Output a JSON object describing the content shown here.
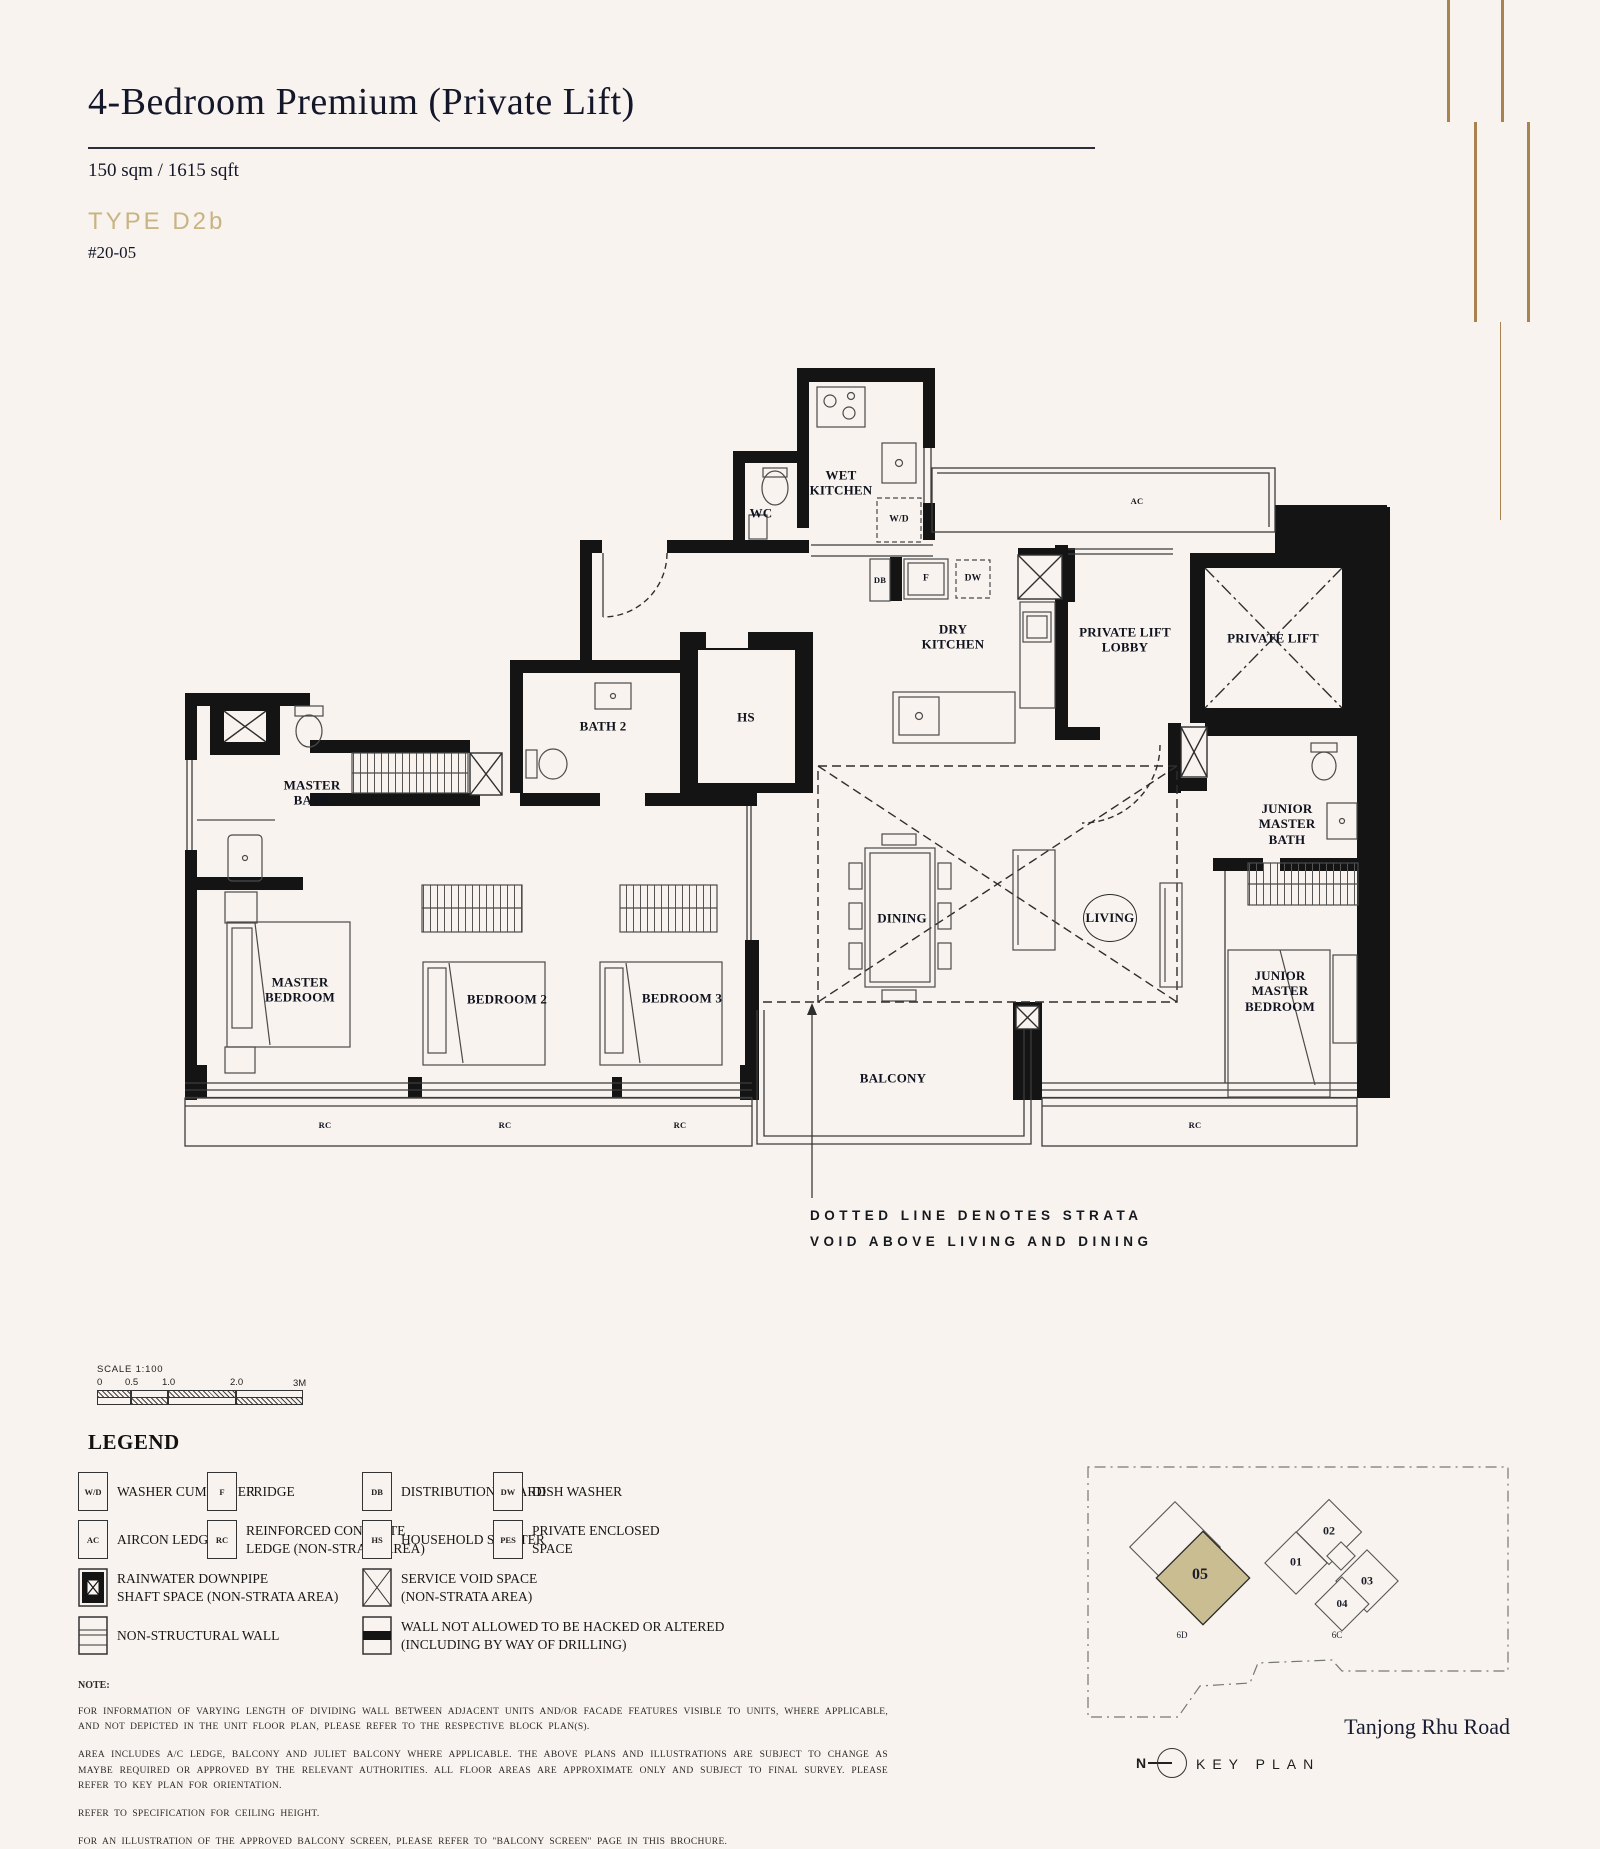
{
  "header": {
    "title": "4-Bedroom Premium (Private Lift)",
    "area": "150 sqm / 1615 sqft",
    "type_label": "TYPE D2b",
    "unit_number": "#20-05"
  },
  "colors": {
    "background": "#f8f3ee",
    "accent_gold": "#c8b483",
    "decor_line_gold": "#a9834f",
    "wall_black": "#141414",
    "highlight_unit_tan": "#cbbd92"
  },
  "plan": {
    "labels": {
      "wet_kitchen": "WET\nKITCHEN",
      "wc": "WC",
      "wd": "W/D",
      "ac": "AC",
      "db": "DB",
      "fridge": "F",
      "dw": "DW",
      "dry_kitchen": "DRY\nKITCHEN",
      "lift_lobby": "PRIVATE LIFT\nLOBBY",
      "lift": "PRIVATE LIFT",
      "hs": "HS",
      "bath2": "BATH 2",
      "master_bath": "MASTER\nBATH",
      "master_bedroom": "MASTER\nBEDROOM",
      "bedroom2": "BEDROOM 2",
      "bedroom3": "BEDROOM 3",
      "dining": "DINING",
      "living": "LIVING",
      "balcony": "BALCONY",
      "junior_master_bath": "JUNIOR\nMASTER\nBATH",
      "junior_master_bedroom": "JUNIOR\nMASTER\nBEDROOM",
      "rc": "RC"
    },
    "annotation": "DOTTED LINE DENOTES STRATA\nVOID ABOVE LIVING AND DINING"
  },
  "scale_bar": {
    "label": "SCALE  1:100",
    "ticks": [
      "0",
      "0.5",
      "1.0",
      "2.0",
      "3M"
    ]
  },
  "legend": {
    "title": "LEGEND",
    "items": [
      {
        "box": "W/D",
        "label": "WASHER CUM DRYER"
      },
      {
        "box": "F",
        "label": "FRIDGE"
      },
      {
        "box": "DB",
        "label": "DISTRIBUTION BOARD"
      },
      {
        "box": "DW",
        "label": "DISH WASHER"
      },
      {
        "box": "AC",
        "label": "AIRCON LEDGE"
      },
      {
        "box": "RC",
        "label": "REINFORCED CONCRETE\nLEDGE (NON-STRATA AREA)"
      },
      {
        "box": "HS",
        "label": "HOUSEHOLD SHELTER"
      },
      {
        "box": "PES",
        "label": "PRIVATE ENCLOSED\nSPACE"
      },
      {
        "box": "",
        "label": "RAINWATER DOWNPIPE\nSHAFT SPACE (NON-STRATA AREA)"
      },
      {
        "box": "",
        "label": "SERVICE VOID SPACE\n(NON-STRATA AREA)"
      },
      {
        "box": "",
        "label": "NON-STRUCTURAL WALL"
      },
      {
        "box": "",
        "label": "WALL NOT ALLOWED TO BE HACKED OR ALTERED\n(INCLUDING BY WAY OF DRILLING)"
      }
    ]
  },
  "notes": {
    "heading": "NOTE:",
    "paragraphs": [
      "FOR  INFORMATION OF  VARYING  LENGTH  OF  DIVIDING WALL  BETWEEN  ADJACENT  UNITS  AND/OR  FACADE  FEATURES  VISIBLE  TO UNITS, WHERE  APPLICABLE,  AND NOT DEPICTED  IN THE UNIT FLOOR PLAN, PLEASE REFER TO THE RESPECTIVE BLOCK PLAN(S).",
      "AREA  INCLUDES  A/C LEDGE,  BALCONY  AND JULIET BALCONY  WHERE  APPLICABLE.   THE ABOVE  PLANS  AND ILLUSTRATIONS  ARE  SUBJECT   TO CHANGE  AS  MAYBE  REQUIRED  OR  APPROVED   BY THE RELEVANT AUTHORITIES. ALL FLOOR AREAS ARE APPROXIMATE ONLY AND SUBJECT TO FINAL SURVEY. PLEASE REFER TO KEY PLAN FOR ORIENTATION.",
      "REFER TO SPECIFICATION FOR CEILING HEIGHT.",
      "FOR AN ILLUSTRATION OF THE APPROVED BALCONY SCREEN, PLEASE REFER TO \"BALCONY SCREEN\" PAGE IN THIS BROCHURE."
    ]
  },
  "key_plan": {
    "title": "KEY PLAN",
    "north": "N",
    "road": "Tanjong Rhu Road",
    "block_left": "6D",
    "block_right": "6C",
    "unit_01": "01",
    "unit_02": "02",
    "unit_03": "03",
    "unit_04": "04",
    "unit_05": "05"
  }
}
